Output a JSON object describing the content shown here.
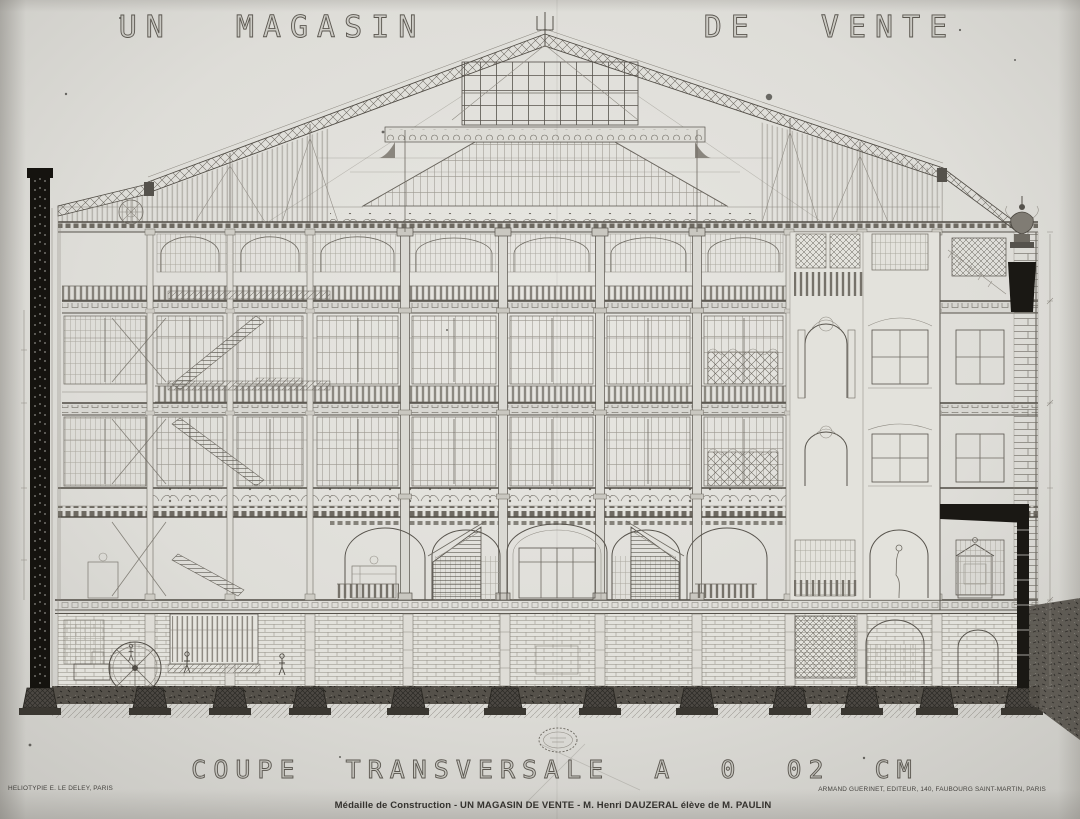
{
  "plate": {
    "title_left": "UN MAGASIN",
    "title_right": "DE VENTE",
    "subtitle": "COUPE TRANSVERSALE A 0 02 CM",
    "caption": "Médaille de Construction - UN MAGASIN DE VENTE - M.  Henri DAUZERAL élève de M. PAULIN",
    "printer_credit": "HELIOTYPIE E. LE DELEY, PARIS",
    "publisher_credit": "ARMAND GUERINET, EDITEUR, 140, FAUBOURG SAINT-MARTIN, PARIS"
  },
  "drawing": {
    "subject": "Transverse section of a department store with glazed truss roof and central atrium skylight",
    "stamp_note": "oval collection stamp, text illegible",
    "colors": {
      "paper": "#dcdbd6",
      "ink": "#57534c",
      "dark_poche": "#1a1814",
      "soil": "#55514a"
    }
  }
}
